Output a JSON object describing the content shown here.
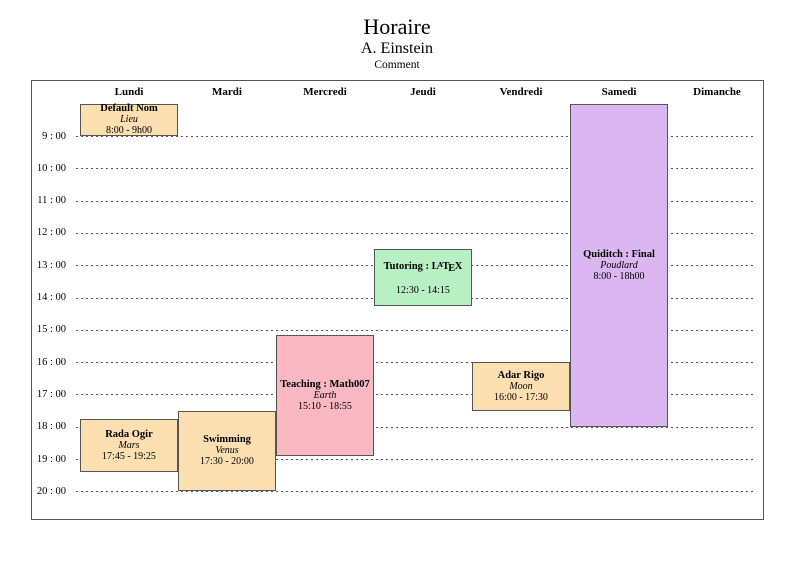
{
  "header": {
    "title": "Horaire",
    "author": "A. Einstein",
    "comment": "Comment"
  },
  "days": [
    "Lundi",
    "Mardi",
    "Mercredi",
    "Jeudi",
    "Vendredi",
    "Samedi",
    "Dimanche"
  ],
  "hours": [
    "9 : 00",
    "10 : 00",
    "11 : 00",
    "12 : 00",
    "13 : 00",
    "14 : 00",
    "15 : 00",
    "16 : 00",
    "17 : 00",
    "18 : 00",
    "19 : 00",
    "20 : 00"
  ],
  "colors": {
    "orange": "#FBDFB1",
    "pink": "#F9B7C1",
    "green": "#B7F0C2",
    "purple": "#DAB7F1",
    "block_border": "#555555",
    "grid_dash": "#555555",
    "chart_border": "#555555"
  },
  "latex_logo_parts": {
    "l": "L",
    "a": "A",
    "t": "T",
    "e": "E",
    "x": "X"
  },
  "events": [
    {
      "title": "Default Nom",
      "location": "Lieu",
      "time": "8:00 - 9h00",
      "day": "Lundi",
      "day_index": 0,
      "start_hour": 8.0,
      "end_hour": 9.0,
      "color": "orange"
    },
    {
      "title": "Rada Ogir",
      "location": "Mars",
      "time": "17:45 - 19:25",
      "day": "Lundi",
      "day_index": 0,
      "start_hour": 17.75,
      "end_hour": 19.4167,
      "color": "orange"
    },
    {
      "title": "Swimming",
      "location": "Venus",
      "time": "17:30 - 20:00",
      "day": "Mardi",
      "day_index": 1,
      "start_hour": 17.5,
      "end_hour": 20.0,
      "color": "orange"
    },
    {
      "title": "Teaching : Math007",
      "location": "Earth",
      "time": "15:10 - 18:55",
      "day": "Mercredi",
      "day_index": 2,
      "start_hour": 15.1667,
      "end_hour": 18.9167,
      "color": "pink"
    },
    {
      "title": "Tutoring : LaTeX",
      "title_prefix": "Tutoring : ",
      "latex_logo": true,
      "location": "",
      "time": "12:30 - 14:15",
      "day": "Jeudi",
      "day_index": 3,
      "start_hour": 12.5,
      "end_hour": 14.25,
      "color": "green"
    },
    {
      "title": "Adar Rigo",
      "location": "Moon",
      "time": "16:00 - 17:30",
      "day": "Vendredi",
      "day_index": 4,
      "start_hour": 16.0,
      "end_hour": 17.5,
      "color": "orange"
    },
    {
      "title": "Quiditch : Final",
      "location": "Poudlard",
      "time": "8:00 - 18h00",
      "day": "Samedi",
      "day_index": 5,
      "start_hour": 8.0,
      "end_hour": 18.0,
      "color": "purple"
    }
  ]
}
